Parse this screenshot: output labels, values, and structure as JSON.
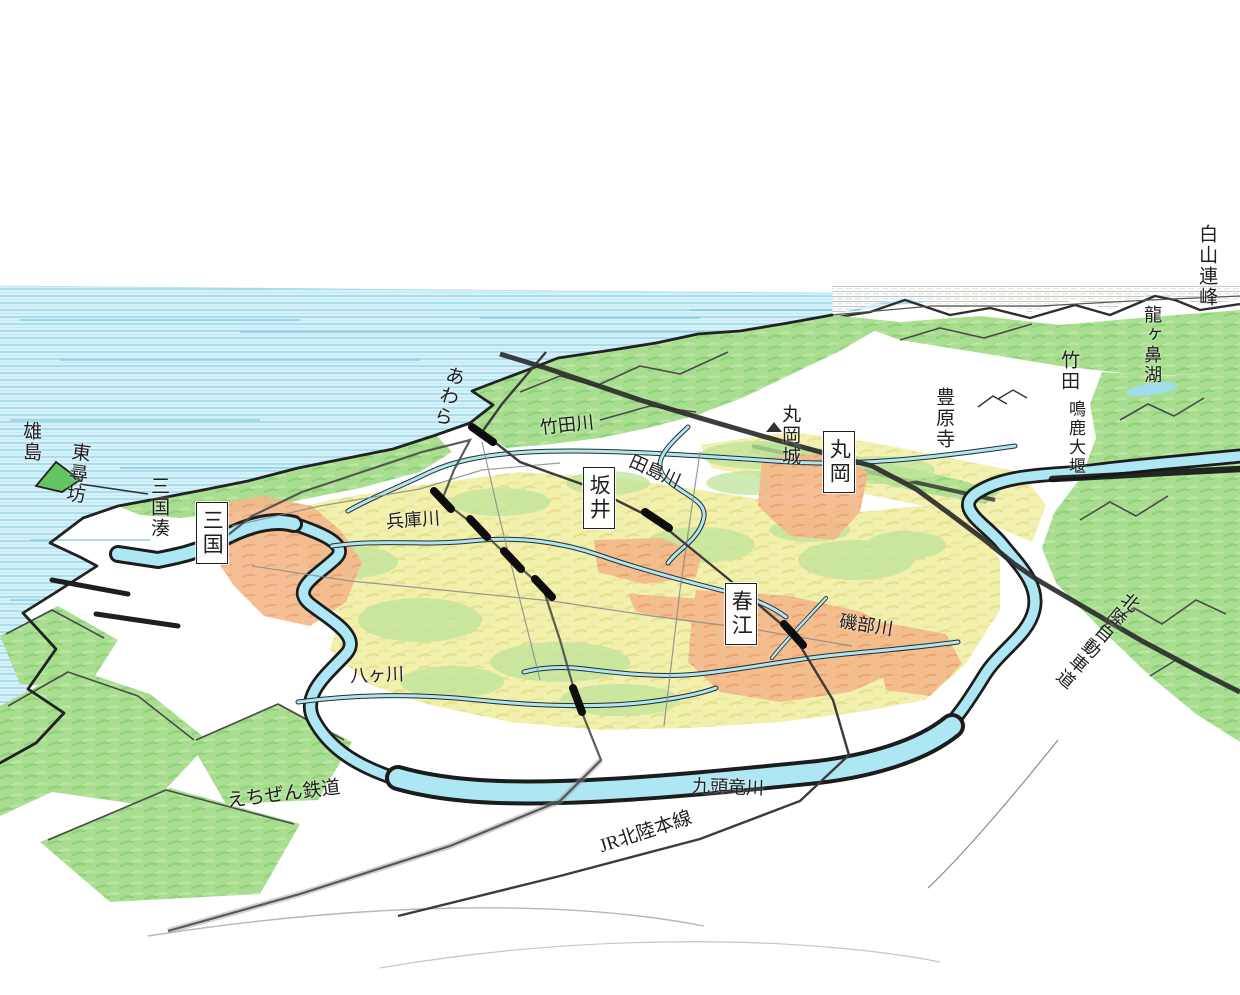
{
  "map": {
    "towns": [
      {
        "label": "三国"
      },
      {
        "label": "坂井"
      },
      {
        "label": "丸岡"
      },
      {
        "label": "春江"
      }
    ],
    "landmarks": [
      {
        "label": "雄島"
      },
      {
        "label": "東尋坊"
      },
      {
        "label": "三国湊"
      },
      {
        "label": "あわら"
      },
      {
        "label": "丸岡城"
      },
      {
        "label": "豊原寺"
      },
      {
        "label": "竹田"
      },
      {
        "label": "鳴鹿大堰"
      },
      {
        "label": "龍ヶ鼻湖"
      },
      {
        "label": "白山連峰"
      }
    ],
    "rivers": [
      {
        "label": "竹田川"
      },
      {
        "label": "田島川"
      },
      {
        "label": "兵庫川"
      },
      {
        "label": "八ヶ川"
      },
      {
        "label": "磯部川"
      },
      {
        "label": "九頭竜川"
      }
    ],
    "railways": [
      {
        "label": "えちぜん鉄道"
      },
      {
        "label": "JR北陸本線"
      }
    ],
    "roads": [
      {
        "label": "北陸自動車道"
      }
    ]
  },
  "colors": {
    "sea": "#d8f1f9",
    "sea_stripe": "#9adced",
    "hill_green": "#a9de90",
    "plain_yellow": "#f2f0ad",
    "plain_green": "#bfe59b",
    "urban_orange": "#f4b98c",
    "river_cyan": "#ade7f3",
    "ink": "#1f1f1f"
  }
}
